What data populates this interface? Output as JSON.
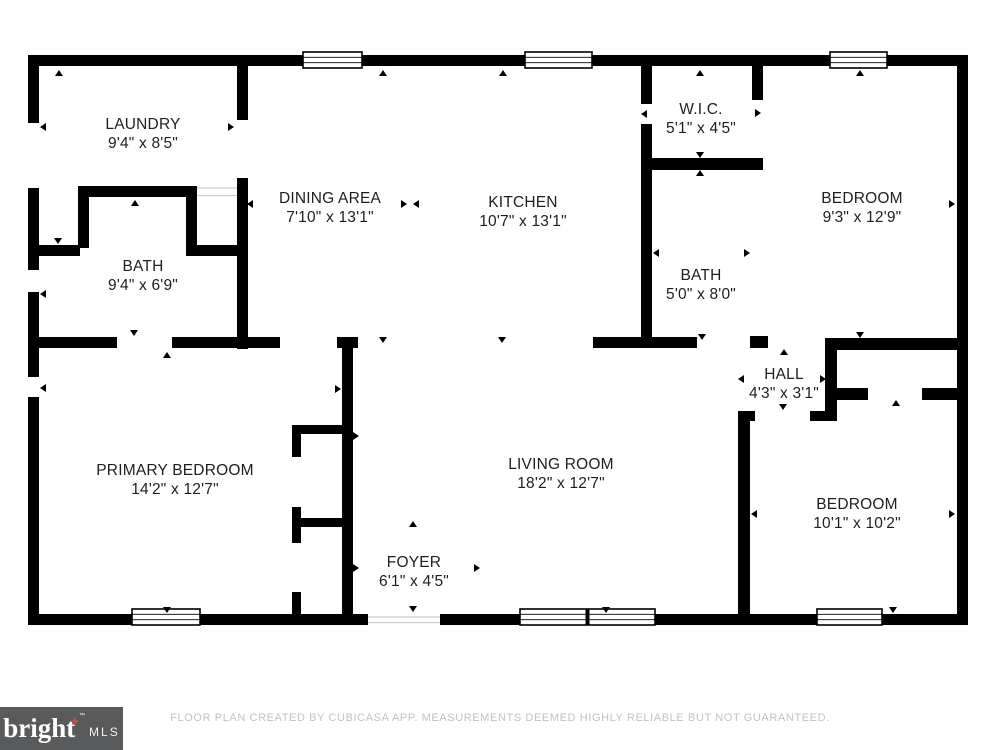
{
  "plan": {
    "rooms": [
      {
        "id": "laundry",
        "name": "LAUNDRY",
        "dims": "9'4\" x 8'5\""
      },
      {
        "id": "bath-left",
        "name": "BATH",
        "dims": "9'4\" x 6'9\""
      },
      {
        "id": "dining-area",
        "name": "DINING AREA",
        "dims": "7'10\" x 13'1\""
      },
      {
        "id": "kitchen",
        "name": "KITCHEN",
        "dims": "10'7\" x 13'1\""
      },
      {
        "id": "wic",
        "name": "W.I.C.",
        "dims": "5'1\" x 4'5\""
      },
      {
        "id": "bath-right",
        "name": "BATH",
        "dims": "5'0\" x 8'0\""
      },
      {
        "id": "bedroom-top-right",
        "name": "BEDROOM",
        "dims": "9'3\" x 12'9\""
      },
      {
        "id": "hall",
        "name": "HALL",
        "dims": "4'3\" x 3'1\""
      },
      {
        "id": "primary-bedroom",
        "name": "PRIMARY BEDROOM",
        "dims": "14'2\" x 12'7\""
      },
      {
        "id": "living-room",
        "name": "LIVING ROOM",
        "dims": "18'2\" x 12'7\""
      },
      {
        "id": "bedroom-bottom-right",
        "name": "BEDROOM",
        "dims": "10'1\" x 10'2\""
      },
      {
        "id": "foyer",
        "name": "FOYER",
        "dims": "6'1\" x 4'5\""
      }
    ]
  },
  "footer": {
    "logo": {
      "brand": "bright",
      "plus": "+",
      "tm": "™",
      "suffix": "MLS"
    },
    "disclaimer": "FLOOR PLAN CREATED BY CUBICASA APP. MEASUREMENTS DEEMED HIGHLY RELIABLE BUT NOT GUARANTEED."
  },
  "colors": {
    "wall": "#000000",
    "background": "#ffffff",
    "logo_bg": "#595a5c",
    "logo_text": "#ffffff",
    "logo_plus": "#cf5540",
    "disclaimer_text": "#c2c2c2"
  }
}
